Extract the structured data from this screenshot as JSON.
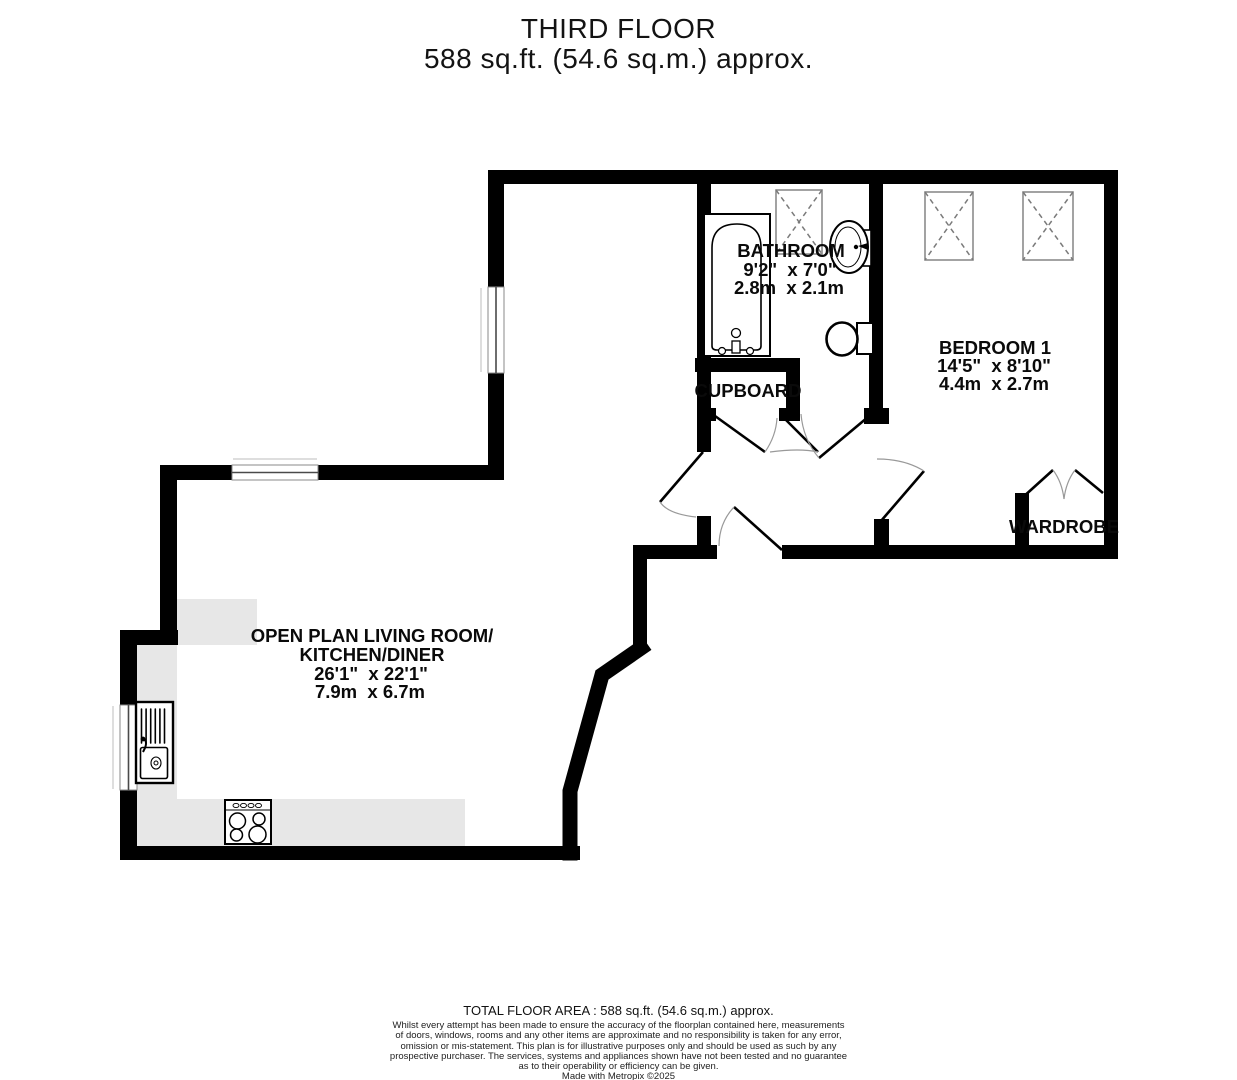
{
  "title": {
    "line1": "THIRD FLOOR",
    "line2": "588 sq.ft. (54.6 sq.m.) approx."
  },
  "rooms": {
    "bathroom": {
      "name": "BATHROOM",
      "size_imperial": "9'2\"  x 7'0\"",
      "size_metric": "2.8m  x 2.1m"
    },
    "bedroom1": {
      "name": "BEDROOM 1",
      "size_imperial": "14'5\"  x 8'10\"",
      "size_metric": "4.4m  x 2.7m"
    },
    "living": {
      "name_line1": "OPEN PLAN LIVING ROOM/",
      "name_line2": "KITCHEN/DINER",
      "size_imperial": "26'1\"  x 22'1\"",
      "size_metric": "7.9m  x 6.7m"
    },
    "cupboard": {
      "name": "CUPBOARD"
    },
    "wardrobe": {
      "name": "WARDROBE"
    }
  },
  "footer": {
    "total_area": "TOTAL FLOOR AREA : 588 sq.ft. (54.6 sq.m.) approx.",
    "disclaimer": [
      "Whilst every attempt has been made to ensure the accuracy of the floorplan contained here, measurements",
      "of doors, windows, rooms and any other items are approximate and no responsibility is taken for any error,",
      "omission or mis-statement. This plan is for illustrative purposes only and should be used as such by any",
      "prospective purchaser. The services, systems and appliances shown have not been tested and no guarantee",
      "as to their operability or efficiency can be given."
    ],
    "credit": "Made with Metropix ©2025"
  },
  "colors": {
    "wall": "#000000",
    "counter": "#e7e7e7",
    "skylight_border": "#8c8c8c",
    "door_arc": "#999999"
  }
}
